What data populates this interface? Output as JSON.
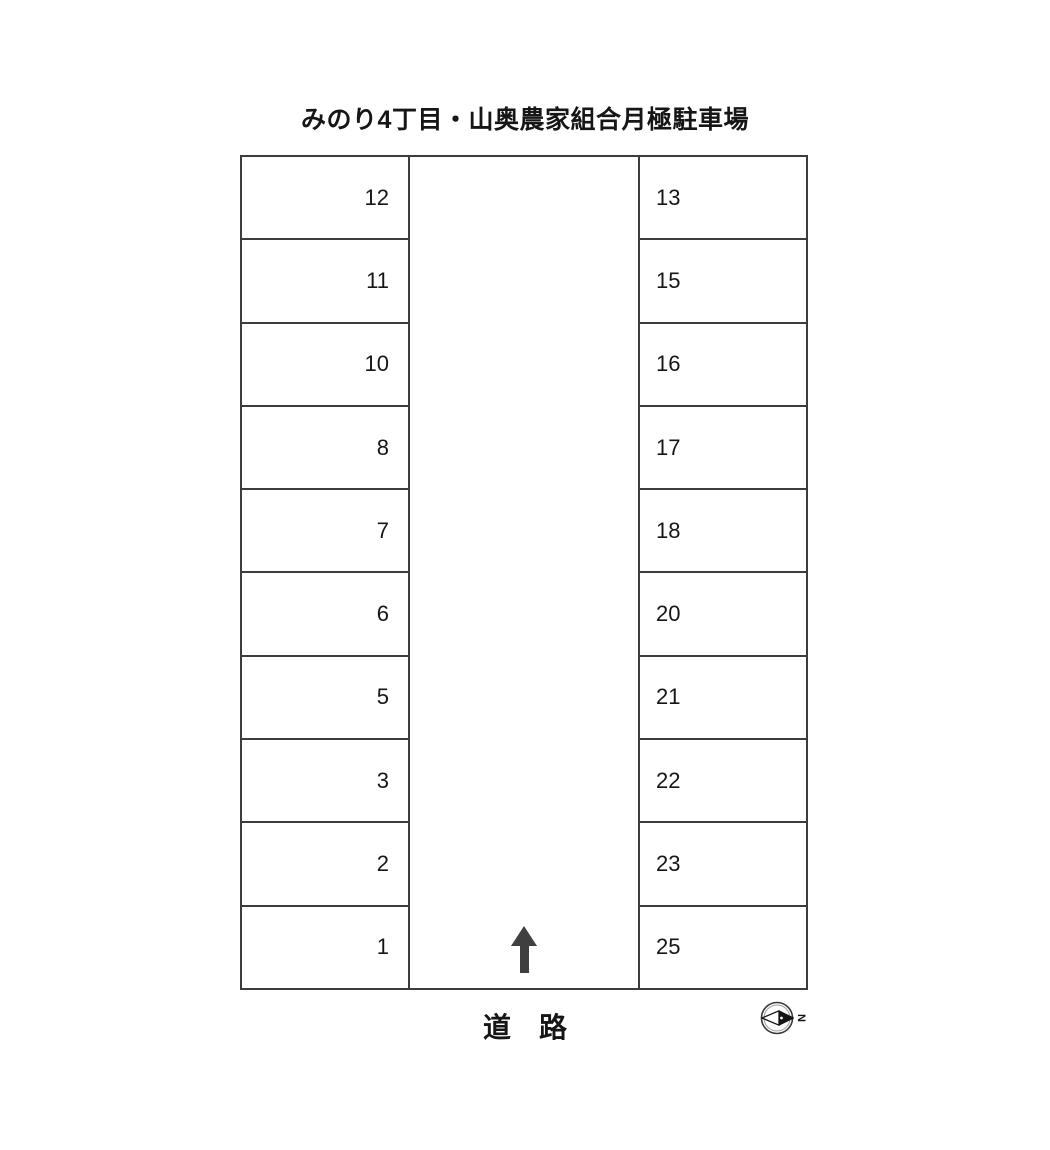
{
  "title": "みのり4丁目・山奥農家組合月極駐車場",
  "lot": {
    "left_column": [
      "12",
      "11",
      "10",
      "8",
      "7",
      "6",
      "5",
      "3",
      "2",
      "1"
    ],
    "right_column": [
      "13",
      "15",
      "16",
      "17",
      "18",
      "20",
      "21",
      "22",
      "23",
      "25"
    ]
  },
  "road_label": "道　路",
  "compass": {
    "north_label": "N"
  },
  "colors": {
    "line": "#3c3c3c",
    "text": "#161616",
    "arrow": "#3f3f3f"
  }
}
